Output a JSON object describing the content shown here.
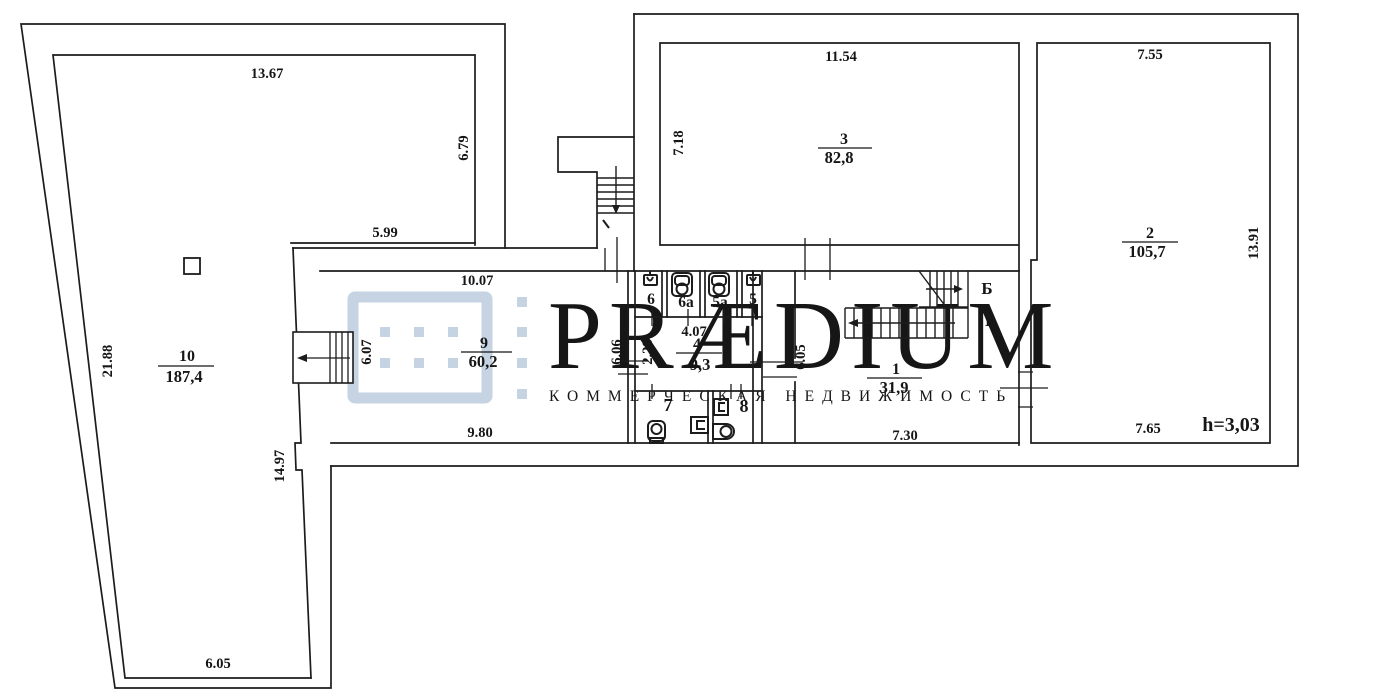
{
  "watermark": {
    "brand": "PRÆDIUM",
    "tagline": "КОММЕРЧЕСКАЯ НЕДВИЖИМОСТЬ",
    "color": "#ccd8e6"
  },
  "floor_plan": {
    "ceiling_height_label": "h=3,03",
    "stair_direction_labels": {
      "b": "Б",
      "i": "I"
    },
    "rooms": {
      "r1": {
        "number": "1",
        "area": "31,9"
      },
      "r2": {
        "number": "2",
        "area": "105,7"
      },
      "r3": {
        "number": "3",
        "area": "82,8"
      },
      "r4": {
        "number": "4",
        "area": "9,3"
      },
      "r5": {
        "number": "5"
      },
      "r5a": {
        "number": "5a"
      },
      "r6": {
        "number": "6"
      },
      "r6a": {
        "number": "6a"
      },
      "r7": {
        "number": "7"
      },
      "r8": {
        "number": "8"
      },
      "r9": {
        "number": "9",
        "area": "60,2"
      },
      "r10": {
        "number": "10",
        "area": "187,4"
      }
    },
    "dimensions": {
      "d_13_67": "13.67",
      "d_6_79": "6.79",
      "d_5_99": "5.99",
      "d_21_88": "21.88",
      "d_14_97": "14.97",
      "d_6_05_bottom": "6.05",
      "d_6_07": "6.07",
      "d_10_07": "10.07",
      "d_9_80": "9.80",
      "d_6_06": "6.06",
      "d_2_28": "2.28",
      "d_4_07": "4.07",
      "d_7_18": "7.18",
      "d_11_54": "11.54",
      "d_7_55": "7.55",
      "d_13_91": "13.91",
      "d_7_65": "7.65",
      "d_7_30": "7.30",
      "d_6_05_corridor": "6.05"
    }
  }
}
